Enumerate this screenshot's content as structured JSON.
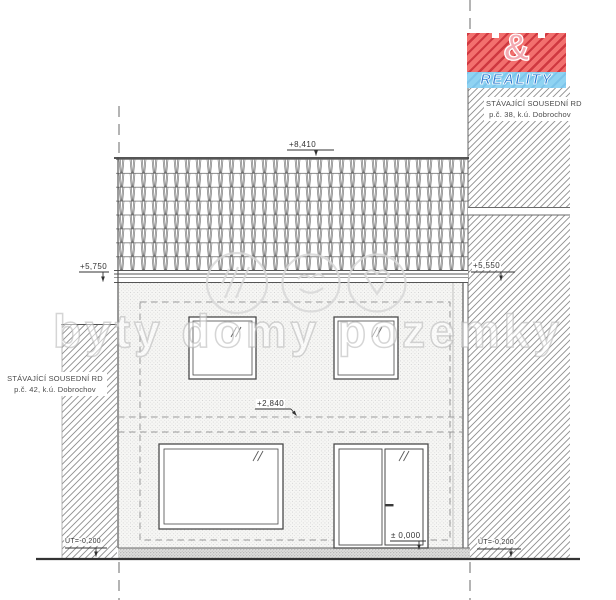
{
  "levels": {
    "ridge": "+8,410",
    "eaves": "+5,750",
    "neighbor_eaves": "+5,550",
    "upper_floor": "+2,840",
    "ground_floor": "± 0,000",
    "terrain_left": "ÚT=-0,200",
    "terrain_right": "ÚT=-0,200"
  },
  "neighbors": {
    "left": {
      "line1": "STÁVAJÍCÍ SOUSEDNÍ RD",
      "line2": "p.č. 42, k.ú. Dobrochov"
    },
    "right": {
      "line1": "STÁVAJÍCÍ SOUSEDNÍ RD",
      "line2": "p.č. 38, k.ú. Dobrochov"
    }
  },
  "logo": {
    "ampersand": "&",
    "brand": "REALITY"
  },
  "watermark": {
    "text": "byty domy pozemky"
  },
  "colors": {
    "line": "#444444",
    "hatch": "#8d8d8d",
    "logo_red": "#f2706e",
    "logo_red_stripe": "#c62a34",
    "logo_blue": "#8fd3f2",
    "logo_blue_text": "#2b7bd0",
    "watermark": "#d8d8d8"
  }
}
